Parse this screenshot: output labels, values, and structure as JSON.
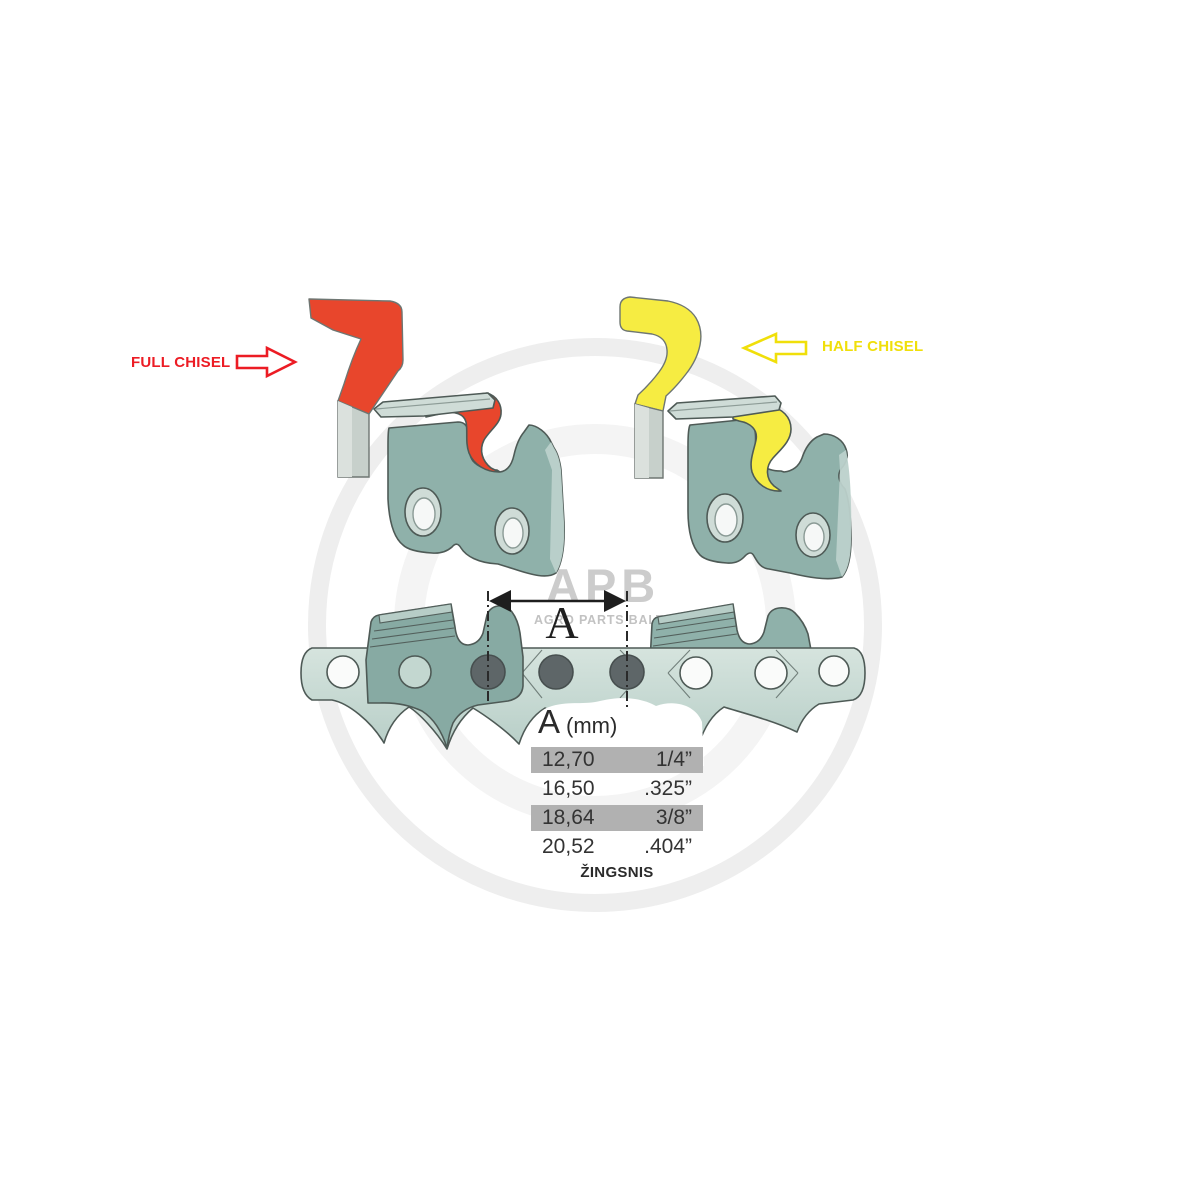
{
  "annotations": {
    "full_chisel_label": "FULL CHISEL",
    "half_chisel_label": "HALF CHISEL",
    "pitch_dimension_label": "A",
    "pitch_caption": "ŽINGSNIS"
  },
  "pitch_table": {
    "header_letter": "A",
    "header_unit": "(mm)",
    "rows": [
      {
        "mm": "12,70",
        "inches": "1/4”",
        "highlighted": true
      },
      {
        "mm": "16,50",
        "inches": ".325”",
        "highlighted": false
      },
      {
        "mm": "18,64",
        "inches": "3/8”",
        "highlighted": true
      },
      {
        "mm": "20,52",
        "inches": ".404”",
        "highlighted": false
      }
    ]
  },
  "watermark": {
    "logo_text": "APB",
    "logo_subtext": "AGRO PARTS BALTIJA"
  },
  "colors": {
    "full_chisel_red": "#e8462c",
    "half_chisel_yellow": "#f6ec42",
    "label_red": "#ec1c24",
    "label_yellow": "#f0df0a",
    "cutter_link_teal": "#8fb1aa",
    "strap_teal_light": "#d6e4de",
    "strap_teal_dark": "#b7cec7",
    "rivet_gray": "#5e6668",
    "table_row_gray": "#b1b1b1",
    "watermark_gray": "#cccccc"
  }
}
